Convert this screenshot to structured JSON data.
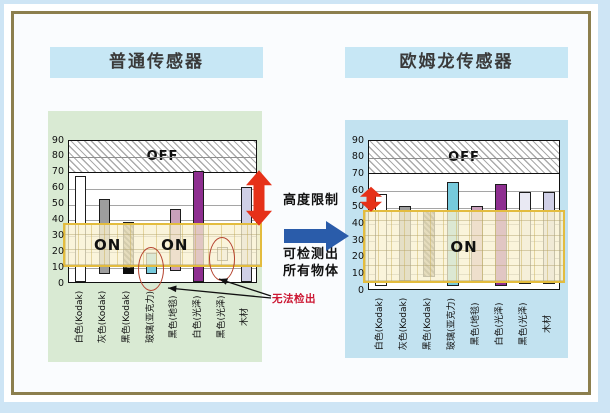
{
  "page": {
    "bg_color": "#CEE5F5",
    "panel_bg": "#FAFCFE",
    "panel_border_color": "#8C7F4E",
    "title_bg": "#C7E7F5"
  },
  "middle": {
    "height_limit_label": "高度限制",
    "detect_line1": "可检测出",
    "detect_line2": "所有物体",
    "cannot_detect_label": "无法检出",
    "red_arrow_color": "#E63119",
    "blue_arrow_color": "#2A5CAA",
    "cannot_detect_color": "#CC1733",
    "ellipse_color": "#B5432F"
  },
  "chart_data": [
    {
      "type": "bar",
      "title": "普通传感器",
      "panel_bg": "#D9EAD3",
      "ylim": [
        0,
        90
      ],
      "yticks": [
        0,
        10,
        20,
        30,
        40,
        50,
        60,
        70,
        80,
        90
      ],
      "grid": true,
      "off_band": {
        "from": 70,
        "to": 90,
        "label": "OFF"
      },
      "on_band": {
        "from": 10,
        "to": 38
      },
      "on_labels": [
        {
          "text": "ON",
          "x_frac": 0.21,
          "value": 24
        },
        {
          "text": "ON",
          "x_frac": 0.565,
          "value": 24
        }
      ],
      "categories": [
        "白色(Kodak)",
        "灰色(Kodak)",
        "黑色(Kodak)",
        "玻璃(亚克力)",
        "黑色(地毯)",
        "白色(光泽)",
        "黑色(光泽)",
        "木材"
      ],
      "bars": [
        {
          "from": 0,
          "to": 67,
          "color": "#FFFFFF"
        },
        {
          "from": 5,
          "to": 52,
          "color": "#9E9E9E"
        },
        {
          "from": 5,
          "to": 38,
          "color": "#8A7D5A",
          "hatch": true,
          "black_tip": true
        },
        {
          "from": 5,
          "to": 18,
          "color": "#76CADC",
          "circled": true
        },
        {
          "from": 7,
          "to": 46,
          "color": "#C9A0BB"
        },
        {
          "from": 0,
          "to": 70,
          "color": "#8E2F90"
        },
        {
          "from": 13,
          "to": 22,
          "color": "#E9E9F3",
          "circled": true
        },
        {
          "from": 0,
          "to": 60,
          "color": "#CFCFE6"
        }
      ],
      "range_arrow": {
        "from": 36,
        "to": 71,
        "side": "right"
      }
    },
    {
      "type": "bar",
      "title": "欧姆龙传感器",
      "panel_bg": "#C2E2F0",
      "ylim": [
        0,
        90
      ],
      "yticks": [
        0,
        10,
        20,
        30,
        40,
        50,
        60,
        70,
        80,
        90
      ],
      "grid": true,
      "off_band": {
        "from": 70,
        "to": 90,
        "label": "OFF"
      },
      "on_band": {
        "from": 4,
        "to": 48
      },
      "on_labels": [
        {
          "text": "ON",
          "x_frac": 0.5,
          "value": 26
        }
      ],
      "categories": [
        "白色(Kodak)",
        "灰色(Kodak)",
        "黑色(Kodak)",
        "玻璃(亚克力)",
        "黑色(地毯)",
        "白色(光泽)",
        "黑色(光泽)",
        "木材"
      ],
      "bars": [
        {
          "from": 2,
          "to": 57,
          "color": "#FFFFFF"
        },
        {
          "from": 5,
          "to": 50,
          "color": "#9E9E9E"
        },
        {
          "from": 7,
          "to": 47,
          "color": "#8A7D5A",
          "hatch": true
        },
        {
          "from": 2,
          "to": 64,
          "color": "#76CADC"
        },
        {
          "from": 5,
          "to": 50,
          "color": "#C9A0BB"
        },
        {
          "from": 2,
          "to": 63,
          "color": "#8E2F90"
        },
        {
          "from": 3,
          "to": 58,
          "color": "#E9E9F3"
        },
        {
          "from": 3,
          "to": 58,
          "color": "#CFCFE6"
        }
      ],
      "range_arrow": {
        "from": 47,
        "to": 62,
        "side": "left"
      }
    }
  ]
}
